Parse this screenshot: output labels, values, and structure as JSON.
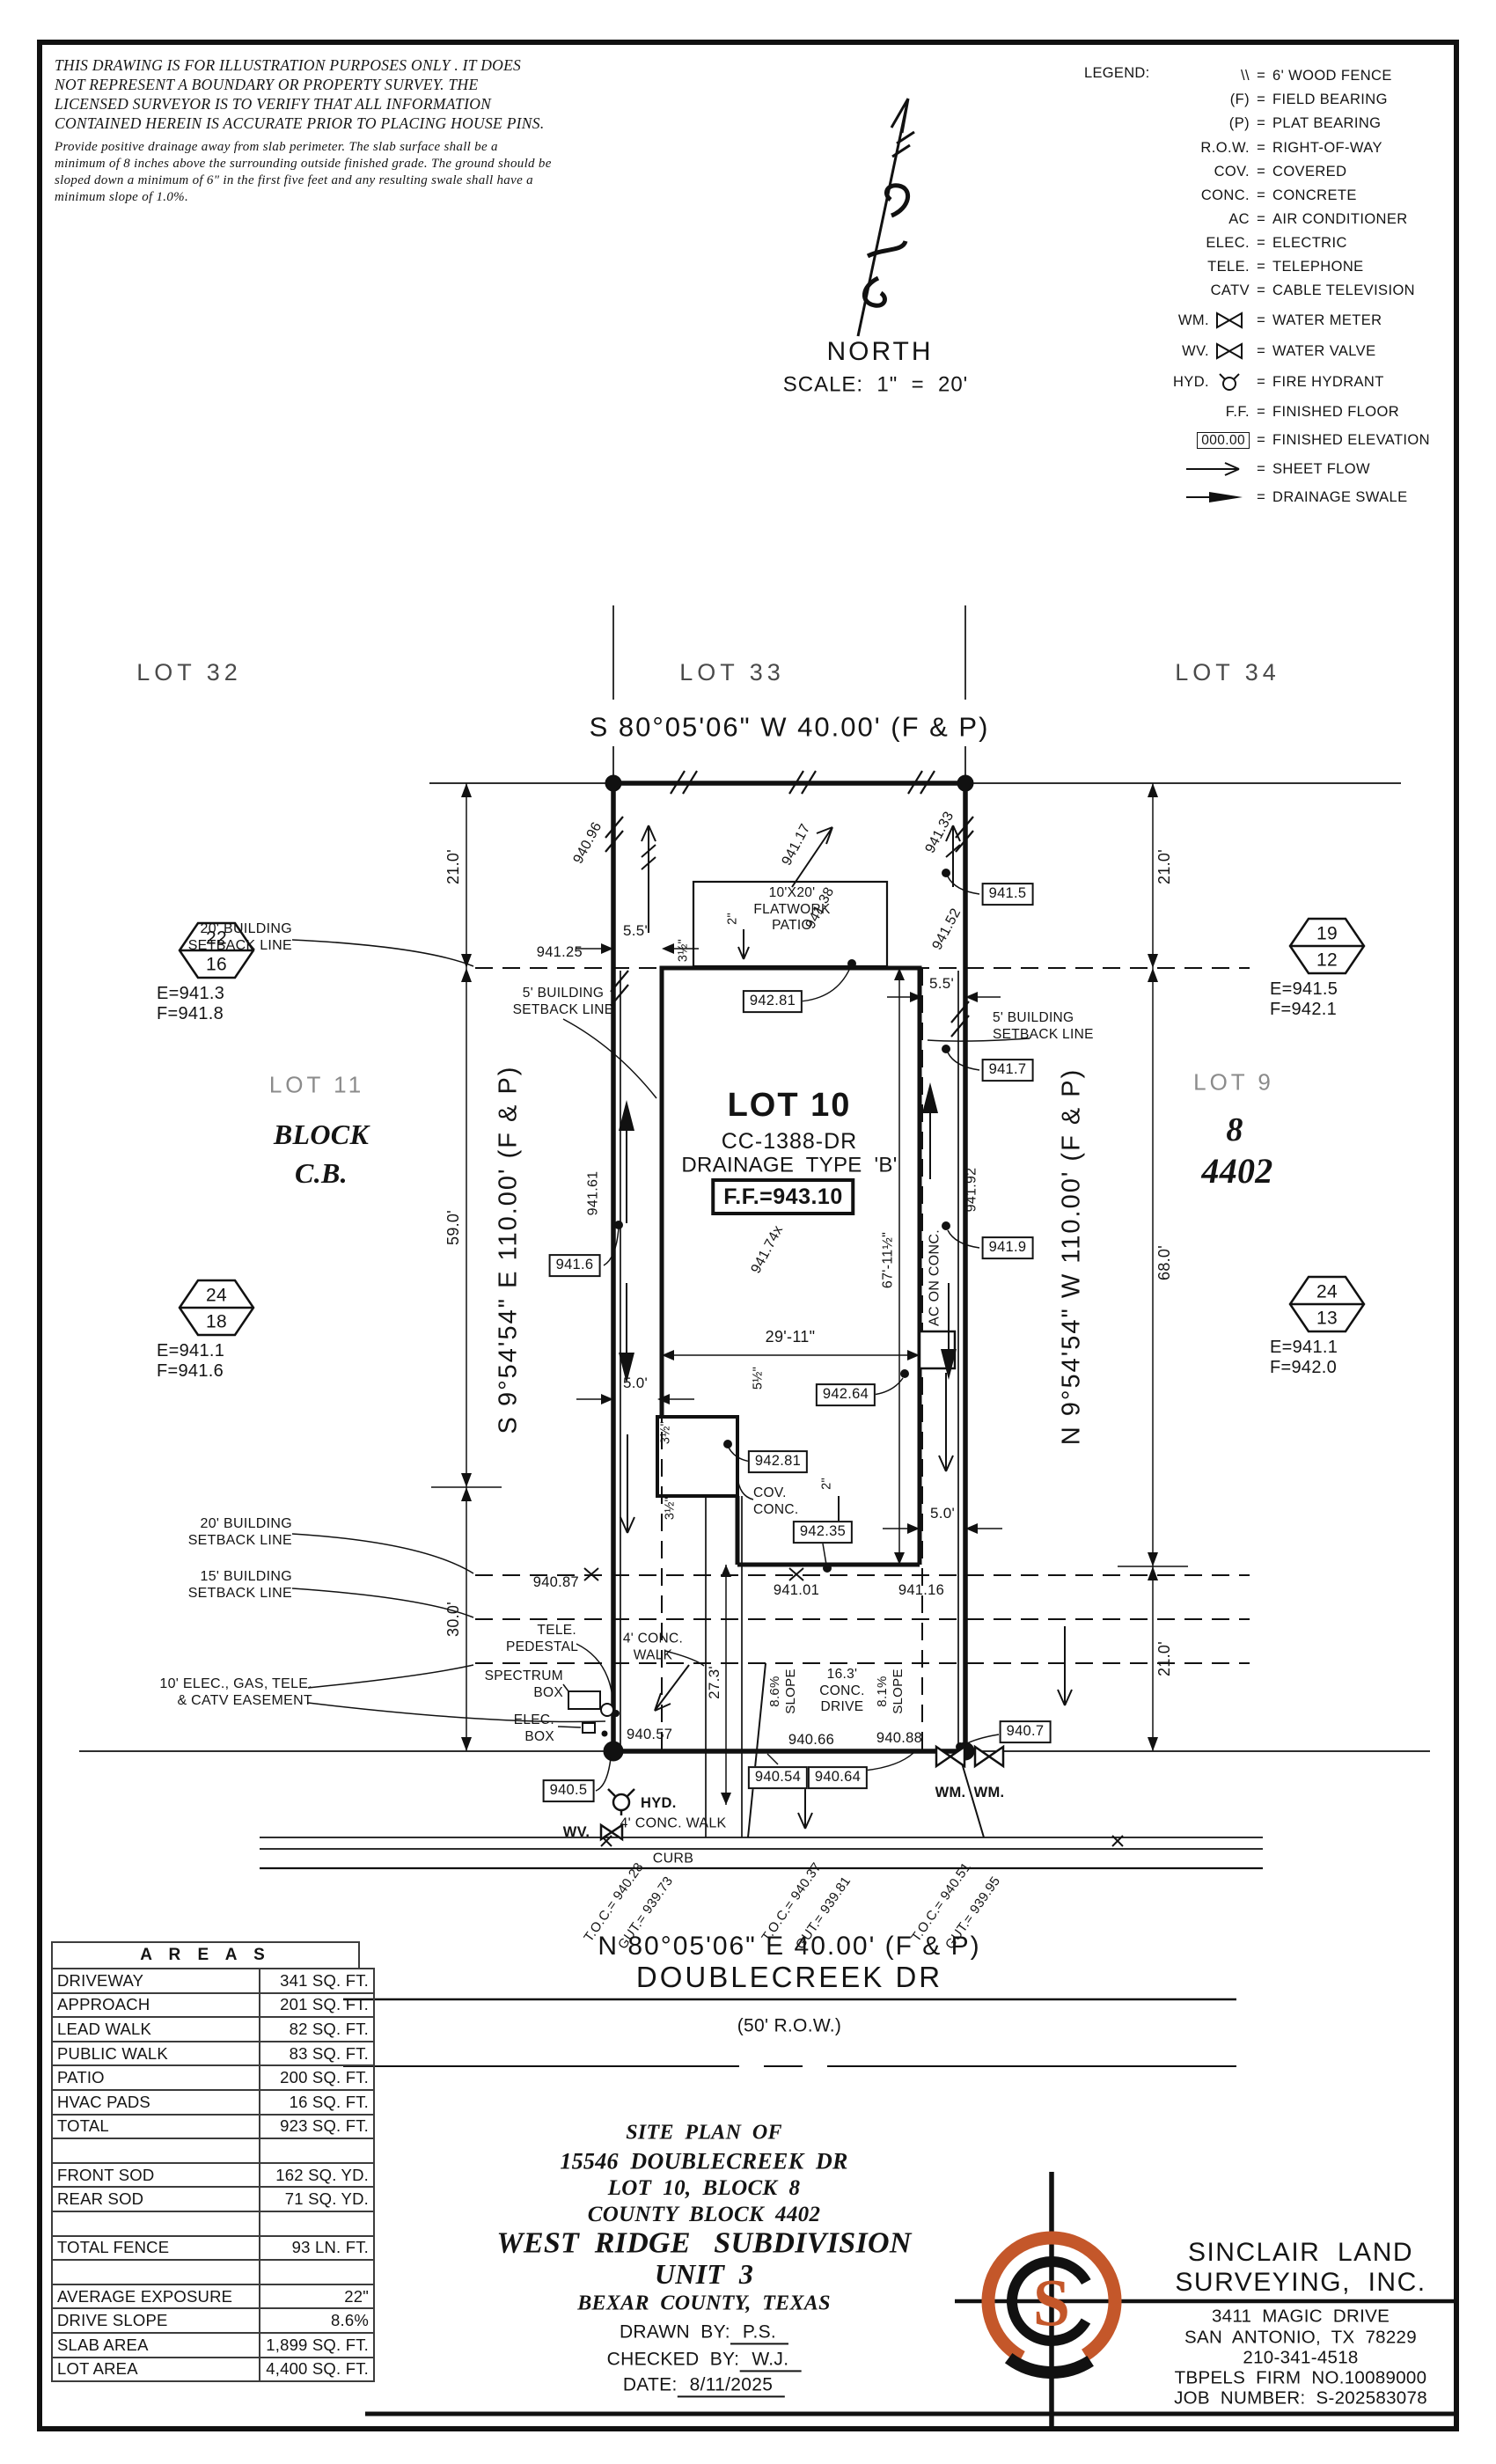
{
  "colors": {
    "ink": "#141414",
    "accent": "#C4572A"
  },
  "disclaimer": {
    "l1": "THIS DRAWING IS FOR ILLUSTRATION PURPOSES ONLY . IT DOES",
    "l2": "NOT REPRESENT A BOUNDARY OR PROPERTY SURVEY. THE",
    "l3": "LICENSED SURVEYOR IS TO VERIFY THAT ALL INFORMATION",
    "l4": "CONTAINED HEREIN IS ACCURATE PRIOR TO PLACING HOUSE PINS.",
    "n1": "Provide positive drainage away from slab perimeter. The slab surface shall be a",
    "n2": "minimum of 8 inches above the surrounding outside finished grade. The ground should be",
    "n3": "sloped down a minimum of 6\" in the first five feet and any resulting swale shall have a",
    "n4": "minimum slope of 1.0%."
  },
  "north": {
    "label": "NORTH",
    "scale": "SCALE:  1\"  =  20'"
  },
  "legend": {
    "title": "LEGEND:",
    "eq": "=",
    "items": [
      {
        "sym": "\\\\",
        "def": "6' WOOD FENCE"
      },
      {
        "sym": "(F)",
        "def": "FIELD BEARING"
      },
      {
        "sym": "(P)",
        "def": "PLAT BEARING"
      },
      {
        "sym": "R.O.W.",
        "def": "RIGHT-OF-WAY"
      },
      {
        "sym": "COV.",
        "def": "COVERED"
      },
      {
        "sym": "CONC.",
        "def": "CONCRETE"
      },
      {
        "sym": "AC",
        "def": "AIR CONDITIONER"
      },
      {
        "sym": "ELEC.",
        "def": "ELECTRIC"
      },
      {
        "sym": "TELE.",
        "def": "TELEPHONE"
      },
      {
        "sym": "CATV",
        "def": "CABLE TELEVISION"
      },
      {
        "sym": "WM.",
        "def": "WATER METER"
      },
      {
        "sym": "WV.",
        "def": "WATER VALVE"
      },
      {
        "sym": "HYD.",
        "def": "FIRE HYDRANT"
      },
      {
        "sym": "F.F.",
        "def": "FINISHED FLOOR"
      },
      {
        "sym": "000.00",
        "def": "FINISHED ELEVATION"
      },
      {
        "sym": "",
        "def": "SHEET FLOW"
      },
      {
        "sym": "",
        "def": "DRAINAGE SWALE"
      }
    ]
  },
  "plan": {
    "lots": {
      "lot32": "LOT 32",
      "lot33": "LOT 33",
      "lot34": "LOT 34",
      "lot11": "LOT 11",
      "lot9": "LOT 9",
      "block_word": "BLOCK",
      "block_cb": "C.B.",
      "block_num": "8",
      "county_block": "4402"
    },
    "lot10": {
      "name": "LOT 10",
      "cc": "CC-1388-DR",
      "drainage": "DRAINAGE  TYPE  'B'",
      "ff": "F.F.=943.10"
    },
    "bearings": {
      "rear": "S 80°05'06\" W 40.00' (F & P)",
      "front": "N 80°05'06\" E 40.00' (F & P)",
      "left": "S 9°54'54\" E 110.00' (F & P)",
      "right": "N 9°54'54\" W 110.00' (F & P)"
    },
    "street": {
      "name": "DOUBLECREEK DR",
      "row": "(50' R.O.W.)"
    },
    "labels": {
      "patio": "10'X20'\nFLATWORK\nPATIO",
      "setback_20": "20' BUILDING\nSETBACK LINE",
      "setback_15": "15' BUILDING\nSETBACK LINE",
      "setback_5": "5' BUILDING\nSETBACK LINE",
      "easement": "10' ELEC., GAS, TELE.\n& CATV EASEMENT",
      "tele_ped": "TELE.\nPEDESTAL",
      "spectrum": "SPECTRUM\nBOX",
      "elec_box": "ELEC.\nBOX",
      "walk_lead": "4' CONC.\nWALK",
      "walk_pub": "4' CONC. WALK",
      "curb": "CURB",
      "cov_conc": "COV.\nCONC.",
      "ac_conc": "AC ON CONC.",
      "drive": "16.3'\nCONC.\nDRIVE",
      "slope86": "8.6%\nSLOPE",
      "slope81": "8.1%\nSLOPE",
      "wm": "WM.",
      "wv": "WV.",
      "hyd": "HYD."
    },
    "dims": {
      "d21": "21.0'",
      "d59": "59.0'",
      "d30": "30.0'",
      "d68": "68.0'",
      "d55": "5.5'",
      "d50": "5.0'",
      "d2911": "29'-11\"",
      "d6711": "67'-11½\"",
      "d273": "27.3'",
      "f2": "2\"",
      "f35": "3½\"",
      "f55": "5½\""
    },
    "elev": {
      "e94096": "940.96",
      "e94117": "941.17",
      "e94133": "941.33",
      "e94138": "941.38",
      "e94152": "941.52",
      "e94161": "941.61",
      "e94125": "941.25",
      "e94174": "941.74x",
      "e94192": "941.92",
      "e94087": "940.87",
      "e94101": "941.01",
      "e94116": "941.16",
      "e94057": "940.57",
      "e94066": "940.66",
      "e94088": "940.88"
    },
    "boxed": {
      "b9415": "941.5",
      "b9417": "941.7",
      "b9419": "941.9",
      "b9416": "941.6",
      "b94281a": "942.81",
      "b94264": "942.64",
      "b94281b": "942.81",
      "b94235": "942.35",
      "b9405": "940.5",
      "b9407": "940.7",
      "b94054": "940.54",
      "b94064": "940.64"
    },
    "toc": {
      "s1": {
        "toc": "T.O.C.= 940.28",
        "gut": "GUT.= 939.73"
      },
      "s2": {
        "toc": "T.O.C.= 940.37",
        "gut": "GUT.= 939.81"
      },
      "s3": {
        "toc": "T.O.C.= 940.51",
        "gut": "GUT.= 939.95"
      }
    },
    "benchmarks": {
      "bm1": {
        "top": "22",
        "bot": "16",
        "e": "E=941.3",
        "f": "F=941.8"
      },
      "bm2": {
        "top": "24",
        "bot": "18",
        "e": "E=941.1",
        "f": "F=941.6"
      },
      "bm3": {
        "top": "19",
        "bot": "12",
        "e": "E=941.5",
        "f": "F=942.1"
      },
      "bm4": {
        "top": "24",
        "bot": "13",
        "e": "E=941.1",
        "f": "F=942.0"
      }
    }
  },
  "areas": {
    "title": "A R E A S",
    "rows": [
      {
        "label": "DRIVEWAY",
        "value": "341 SQ. FT."
      },
      {
        "label": "APPROACH",
        "value": "201 SQ. FT."
      },
      {
        "label": "LEAD WALK",
        "value": "82 SQ. FT."
      },
      {
        "label": "PUBLIC WALK",
        "value": "83 SQ. FT."
      },
      {
        "label": "PATIO",
        "value": "200 SQ. FT."
      },
      {
        "label": "HVAC PADS",
        "value": "16 SQ. FT."
      },
      {
        "label": "TOTAL",
        "value": "923 SQ. FT."
      },
      {
        "label": "",
        "value": ""
      },
      {
        "label": "FRONT SOD",
        "value": "162 SQ. YD."
      },
      {
        "label": "REAR SOD",
        "value": "71 SQ. YD."
      },
      {
        "label": "",
        "value": ""
      },
      {
        "label": "TOTAL FENCE",
        "value": "93 LN. FT."
      },
      {
        "label": "",
        "value": ""
      },
      {
        "label": "AVERAGE EXPOSURE",
        "value": "22\""
      },
      {
        "label": "DRIVE SLOPE",
        "value": "8.6%"
      },
      {
        "label": "SLAB AREA",
        "value": "1,899 SQ. FT."
      },
      {
        "label": "LOT AREA",
        "value": "4,400 SQ. FT."
      }
    ]
  },
  "title_block": {
    "l1": "SITE  PLAN  OF",
    "l2": "15546  DOUBLECREEK  DR",
    "l3": "LOT  10,  BLOCK  8",
    "l4": "COUNTY  BLOCK  4402",
    "l5": "WEST  RIDGE   SUBDIVISION",
    "l6": "UNIT  3",
    "l7": "BEXAR  COUNTY,  TEXAS",
    "drawn_label": "DRAWN  BY:",
    "drawn": "P.S.",
    "checked_label": "CHECKED  BY:",
    "checked": "W.J.",
    "date_label": "DATE:",
    "date": "8/11/2025"
  },
  "surveyor": {
    "name1": "SINCLAIR  LAND",
    "name2": "SURVEYING,  INC.",
    "addr1": "3411  MAGIC  DRIVE",
    "addr2": "SAN  ANTONIO,  TX  78229",
    "phone": "210-341-4518",
    "firm": "TBPELS  FIRM  NO.10089000",
    "job": "JOB  NUMBER:  S-202583078",
    "logo_letter": "S"
  }
}
